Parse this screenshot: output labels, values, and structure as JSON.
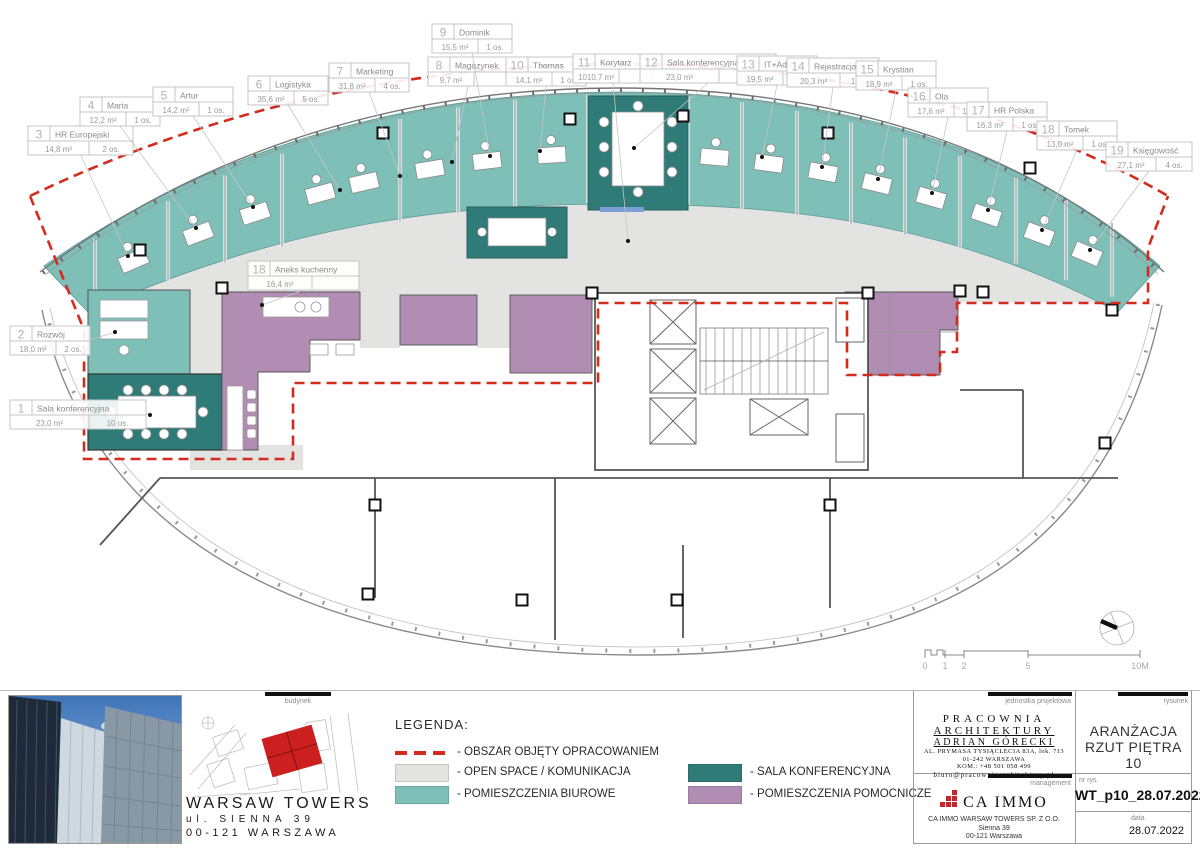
{
  "plan": {
    "rooms": [
      {
        "no": "1",
        "name": "Sala konferencyjna",
        "area": "23,0 m²",
        "occ": "10 os.",
        "lx": 10,
        "ly": 400,
        "tx": 150,
        "ty": 415,
        "side": "left"
      },
      {
        "no": "2",
        "name": "Rozwój",
        "area": "18,0 m²",
        "occ": "2 os.",
        "lx": 10,
        "ly": 326,
        "tx": 115,
        "ty": 332,
        "side": "left"
      },
      {
        "no": "3",
        "name": "HR Europejski",
        "area": "14,8 m²",
        "occ": "2 os.",
        "lx": 28,
        "ly": 126,
        "tx": 128,
        "ty": 256,
        "side": "top"
      },
      {
        "no": "4",
        "name": "Maria",
        "area": "12,2 m²",
        "occ": "1 os.",
        "lx": 80,
        "ly": 97,
        "tx": 196,
        "ty": 228,
        "side": "top"
      },
      {
        "no": "5",
        "name": "Artur",
        "area": "14,2 m²",
        "occ": "1 os.",
        "lx": 153,
        "ly": 87,
        "tx": 253,
        "ty": 207,
        "side": "top"
      },
      {
        "no": "6",
        "name": "Logistyka",
        "area": "35,6 m²",
        "occ": "5 os.",
        "lx": 248,
        "ly": 76,
        "tx": 340,
        "ty": 190,
        "side": "top"
      },
      {
        "no": "7",
        "name": "Marketing",
        "area": "31,8 m²",
        "occ": "4 os.",
        "lx": 329,
        "ly": 63,
        "tx": 400,
        "ty": 176,
        "side": "top"
      },
      {
        "no": "8",
        "name": "Magazynek",
        "area": "9,7 m²",
        "occ": "",
        "lx": 428,
        "ly": 57,
        "tx": 452,
        "ty": 162,
        "side": "top"
      },
      {
        "no": "9",
        "name": "Dominik",
        "area": "15,5 m²",
        "occ": "1 os.",
        "lx": 432,
        "ly": 24,
        "tx": 490,
        "ty": 156,
        "side": "top"
      },
      {
        "no": "10",
        "name": "Thomas",
        "area": "14,1 m²",
        "occ": "1 os.",
        "lx": 506,
        "ly": 57,
        "tx": 540,
        "ty": 151,
        "side": "top"
      },
      {
        "no": "11",
        "name": "Korytarz",
        "area": "1010,7 m²",
        "occ": "",
        "lx": 573,
        "ly": 54,
        "tx": 628,
        "ty": 241,
        "side": "top"
      },
      {
        "no": "12",
        "name": "Sala konferencyjna",
        "area": "23,0 m²",
        "occ": "8 os.",
        "lx": 640,
        "ly": 54,
        "tx": 634,
        "ty": 148,
        "side": "top"
      },
      {
        "no": "13",
        "name": "IT+Admin",
        "area": "19,5 m²",
        "occ": "2 os.",
        "lx": 737,
        "ly": 56,
        "tx": 762,
        "ty": 157,
        "side": "top"
      },
      {
        "no": "14",
        "name": "Rejestracja",
        "area": "20,3 m²",
        "occ": "1 os.",
        "lx": 787,
        "ly": 58,
        "tx": 822,
        "ty": 167,
        "side": "top"
      },
      {
        "no": "15",
        "name": "Krystian",
        "area": "18,9 m²",
        "occ": "1 os.",
        "lx": 856,
        "ly": 61,
        "tx": 878,
        "ty": 179,
        "side": "top"
      },
      {
        "no": "16",
        "name": "Ola",
        "area": "17,6 m²",
        "occ": "1 os.",
        "lx": 908,
        "ly": 88,
        "tx": 932,
        "ty": 193,
        "side": "top"
      },
      {
        "no": "17",
        "name": "HR Polska",
        "area": "16,3 m²",
        "occ": "1 os.",
        "lx": 967,
        "ly": 102,
        "tx": 988,
        "ty": 210,
        "side": "top"
      },
      {
        "no": "18",
        "name": "Tomek",
        "area": "13,0 m²",
        "occ": "1 os.",
        "lx": 1037,
        "ly": 121,
        "tx": 1042,
        "ty": 230,
        "side": "top"
      },
      {
        "no": "19",
        "name": "Księgowość",
        "area": "27,1 m²",
        "occ": "4 os.",
        "lx": 1106,
        "ly": 142,
        "tx": 1090,
        "ty": 250,
        "side": "top"
      },
      {
        "no": "18",
        "name": "Aneks kuchenny",
        "area": "16,4 m²",
        "occ": "",
        "lx": 248,
        "ly": 261,
        "tx": 262,
        "ty": 305,
        "side": "top"
      }
    ]
  },
  "legend": {
    "title": "LEGENDA:",
    "items": [
      {
        "kind": "dash",
        "label": "- OBSZAR OBJĘTY OPRACOWANIEM",
        "color": "#d32b1e"
      },
      {
        "kind": "swatch",
        "label": "- OPEN SPACE / KOMUNIKACJA",
        "color": "#e3e3e2"
      },
      {
        "kind": "swatch",
        "label": "- POMIESZCZENIA BIUROWE",
        "color": "#7ebfb8"
      },
      {
        "kind": "swatch",
        "label": "- SALA KONFERENCYJNA",
        "color": "#2f7b77"
      },
      {
        "kind": "swatch",
        "label": "- POMIESZCZENIA POMOCNICZE",
        "color": "#b18cb3"
      }
    ]
  },
  "panel": {
    "budynek_label": "budynek",
    "building_name": "WARSAW TOWERS",
    "address_1": "ul. SIENNA 39",
    "address_2": "00-121 WARSZAWA",
    "jednostka_label": "jednostka projektowa",
    "studio_name_1": "PRACOWNIA",
    "studio_name_2": "ARCHITEKTURY",
    "studio_name_3": "ADRIAN GÓRECKI",
    "studio_addr_1": "AL. PRYMASA TYSIĄCLECIA 83A, lok. 713",
    "studio_addr_2": "01-242 WARSZAWA",
    "studio_addr_3": "KOM.: +48 501 058 499",
    "studio_email": "biuro@pracowniaarchitektury.pl",
    "rysunek_label": "rysunek",
    "drawing_title_1": "ARANŻACJA",
    "drawing_title_2": "RZUT PIĘTRA 10",
    "management_label": "management",
    "ca_immo": "CA IMMO",
    "mgmt_line_1": "CA IMMO WARSAW TOWERS SP. Z O.O.",
    "mgmt_line_2": "Sienna 39",
    "mgmt_line_3": "00-121 Warszawa",
    "nr_label": "nr rys.",
    "nr_value": "WT_p10_28.07.2022",
    "data_label": "data",
    "data_value": "28.07.2022"
  },
  "scalebar": {
    "labels": [
      "0",
      "1",
      "2",
      "5",
      "10M"
    ]
  }
}
